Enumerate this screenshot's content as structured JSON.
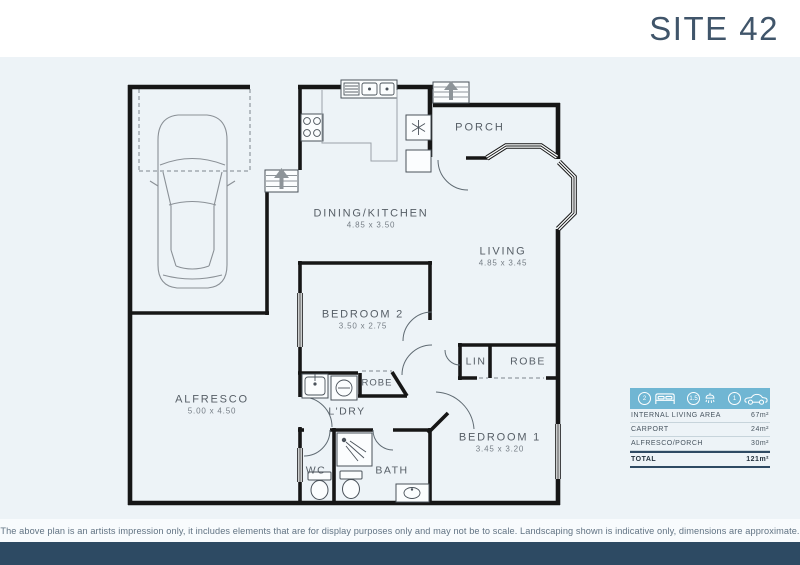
{
  "header": {
    "title": "SITE 42"
  },
  "plan": {
    "rooms": [
      {
        "name": "DINING/KITCHEN",
        "dims": "4.85 x 3.50"
      },
      {
        "name": "LIVING",
        "dims": "4.85 x 3.45"
      },
      {
        "name": "BEDROOM 2",
        "dims": "3.50 x 2.75"
      },
      {
        "name": "BEDROOM 1",
        "dims": "3.45 x 3.20"
      },
      {
        "name": "ALFRESCO",
        "dims": "5.00 x 4.50"
      }
    ],
    "labels": {
      "porch": "PORCH",
      "ldry": "L'DRY",
      "bath": "BATH",
      "wc": "WC",
      "robe_bed2": "ROBE",
      "robe_bed1": "ROBE",
      "lin": "LIN"
    }
  },
  "summary": {
    "badges": [
      {
        "count": "2",
        "icon": "bed-icon"
      },
      {
        "count": "1.5",
        "icon": "shower-icon"
      },
      {
        "count": "1",
        "icon": "car-icon"
      }
    ],
    "rows": [
      {
        "label": "INTERNAL LIVING AREA",
        "value": "67m²"
      },
      {
        "label": "CARPORT",
        "value": "24m²"
      },
      {
        "label": "ALFRESCO/PORCH",
        "value": "30m²"
      }
    ],
    "total": {
      "label": "TOTAL",
      "value": "121m²"
    }
  },
  "disclaimer": "The above plan is an artists impression only, it includes elements that are for display purposes only and may not be to scale. Landscaping shown is indicative only, dimensions are approximate.",
  "colors": {
    "accent_blue": "#70b6d3",
    "footer_navy": "#2d4a63",
    "title_color": "#40556a",
    "plan_background": "#edf3f7"
  }
}
